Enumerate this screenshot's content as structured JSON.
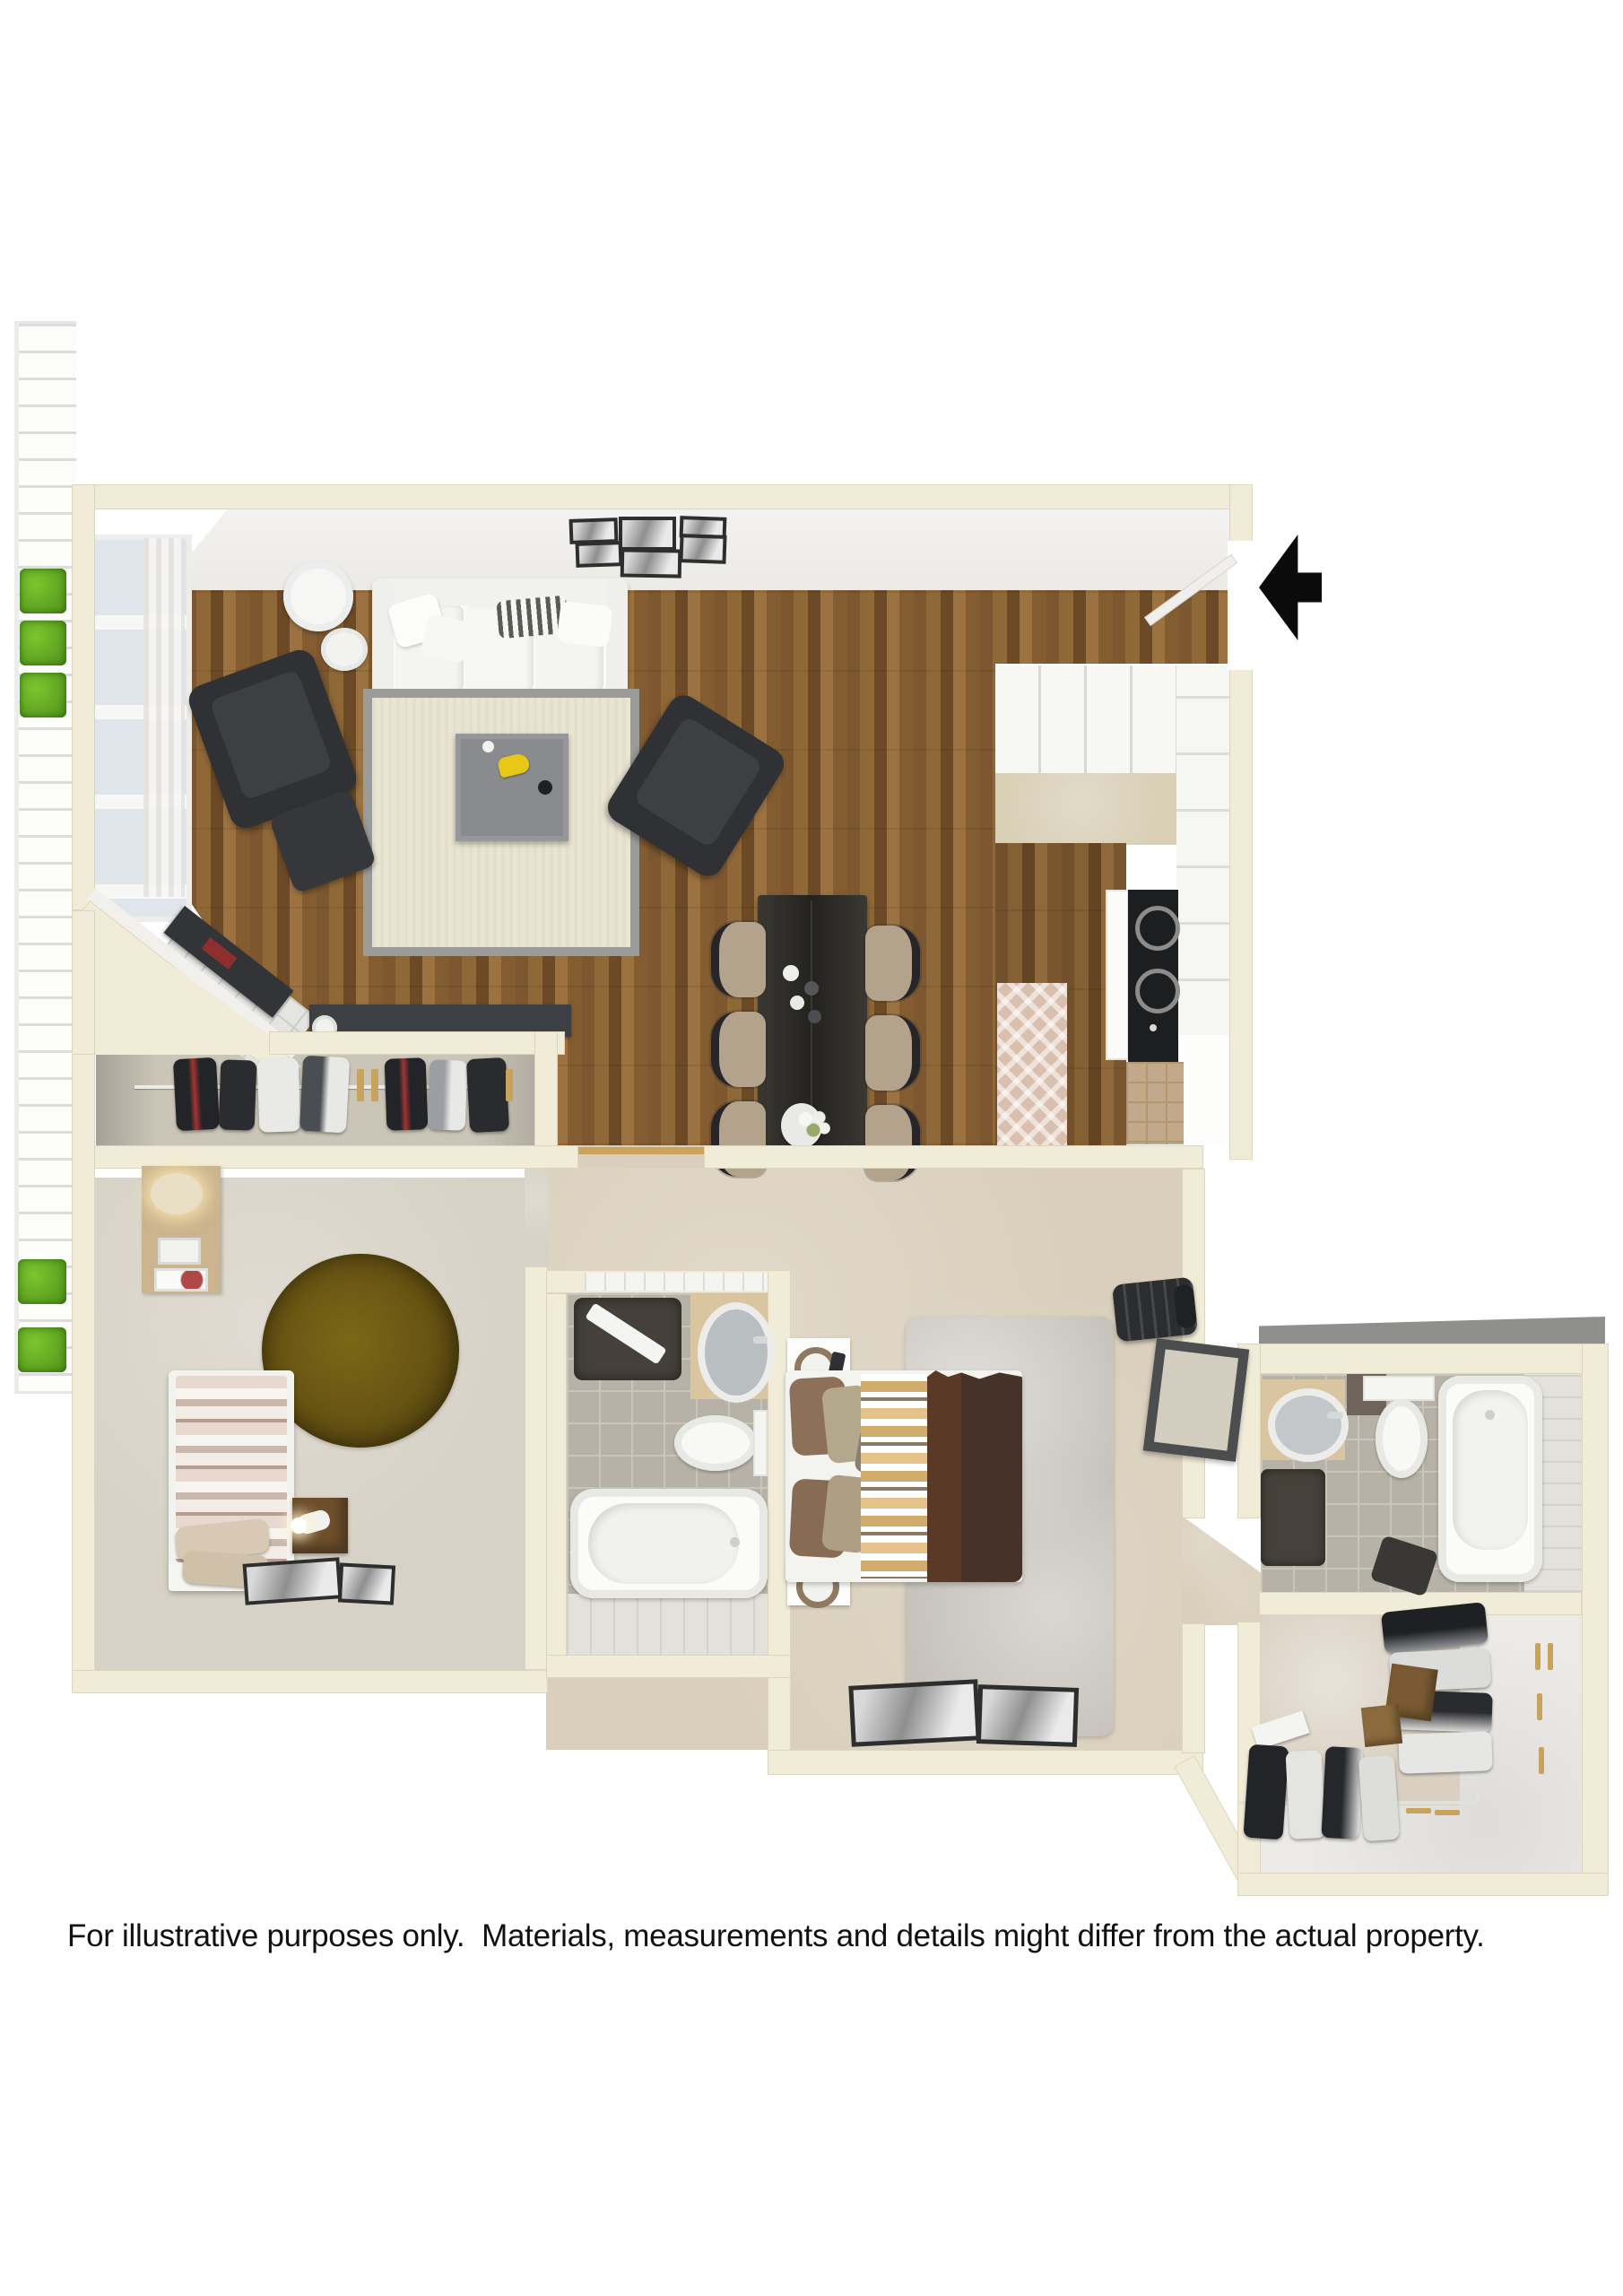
{
  "disclaimer": "For illustrative purposes only.  Materials, measurements and details might differ from the actual property.",
  "entry": {
    "arrow_icon": "entry-arrow-left",
    "arrow_color": "#0b0b0b"
  },
  "palette": {
    "wall": "#f1ecd7",
    "wallEdge": "#ddd6bc",
    "wallFace": "#eceae6",
    "carpet": "#d9cfbc",
    "carpetCool": "#d7d2c6",
    "closetFloor": "#cbc5b7",
    "tile": "#b7b2a8",
    "grout": "#cac5bb",
    "plankLight": "#e3e1da",
    "rugBeige": "#eae4d2",
    "rugBorder": "#9b9b99",
    "rugGrey": "#c6c2bb",
    "oliveRug": "#665313",
    "counter": "#d9c5a0",
    "gold": "#c8a35c",
    "green": "#4f8f1a",
    "furnitureBlack": "#2c2d2f",
    "blanketBrown": "#5a3a27",
    "woodMid": "#8a6233"
  }
}
